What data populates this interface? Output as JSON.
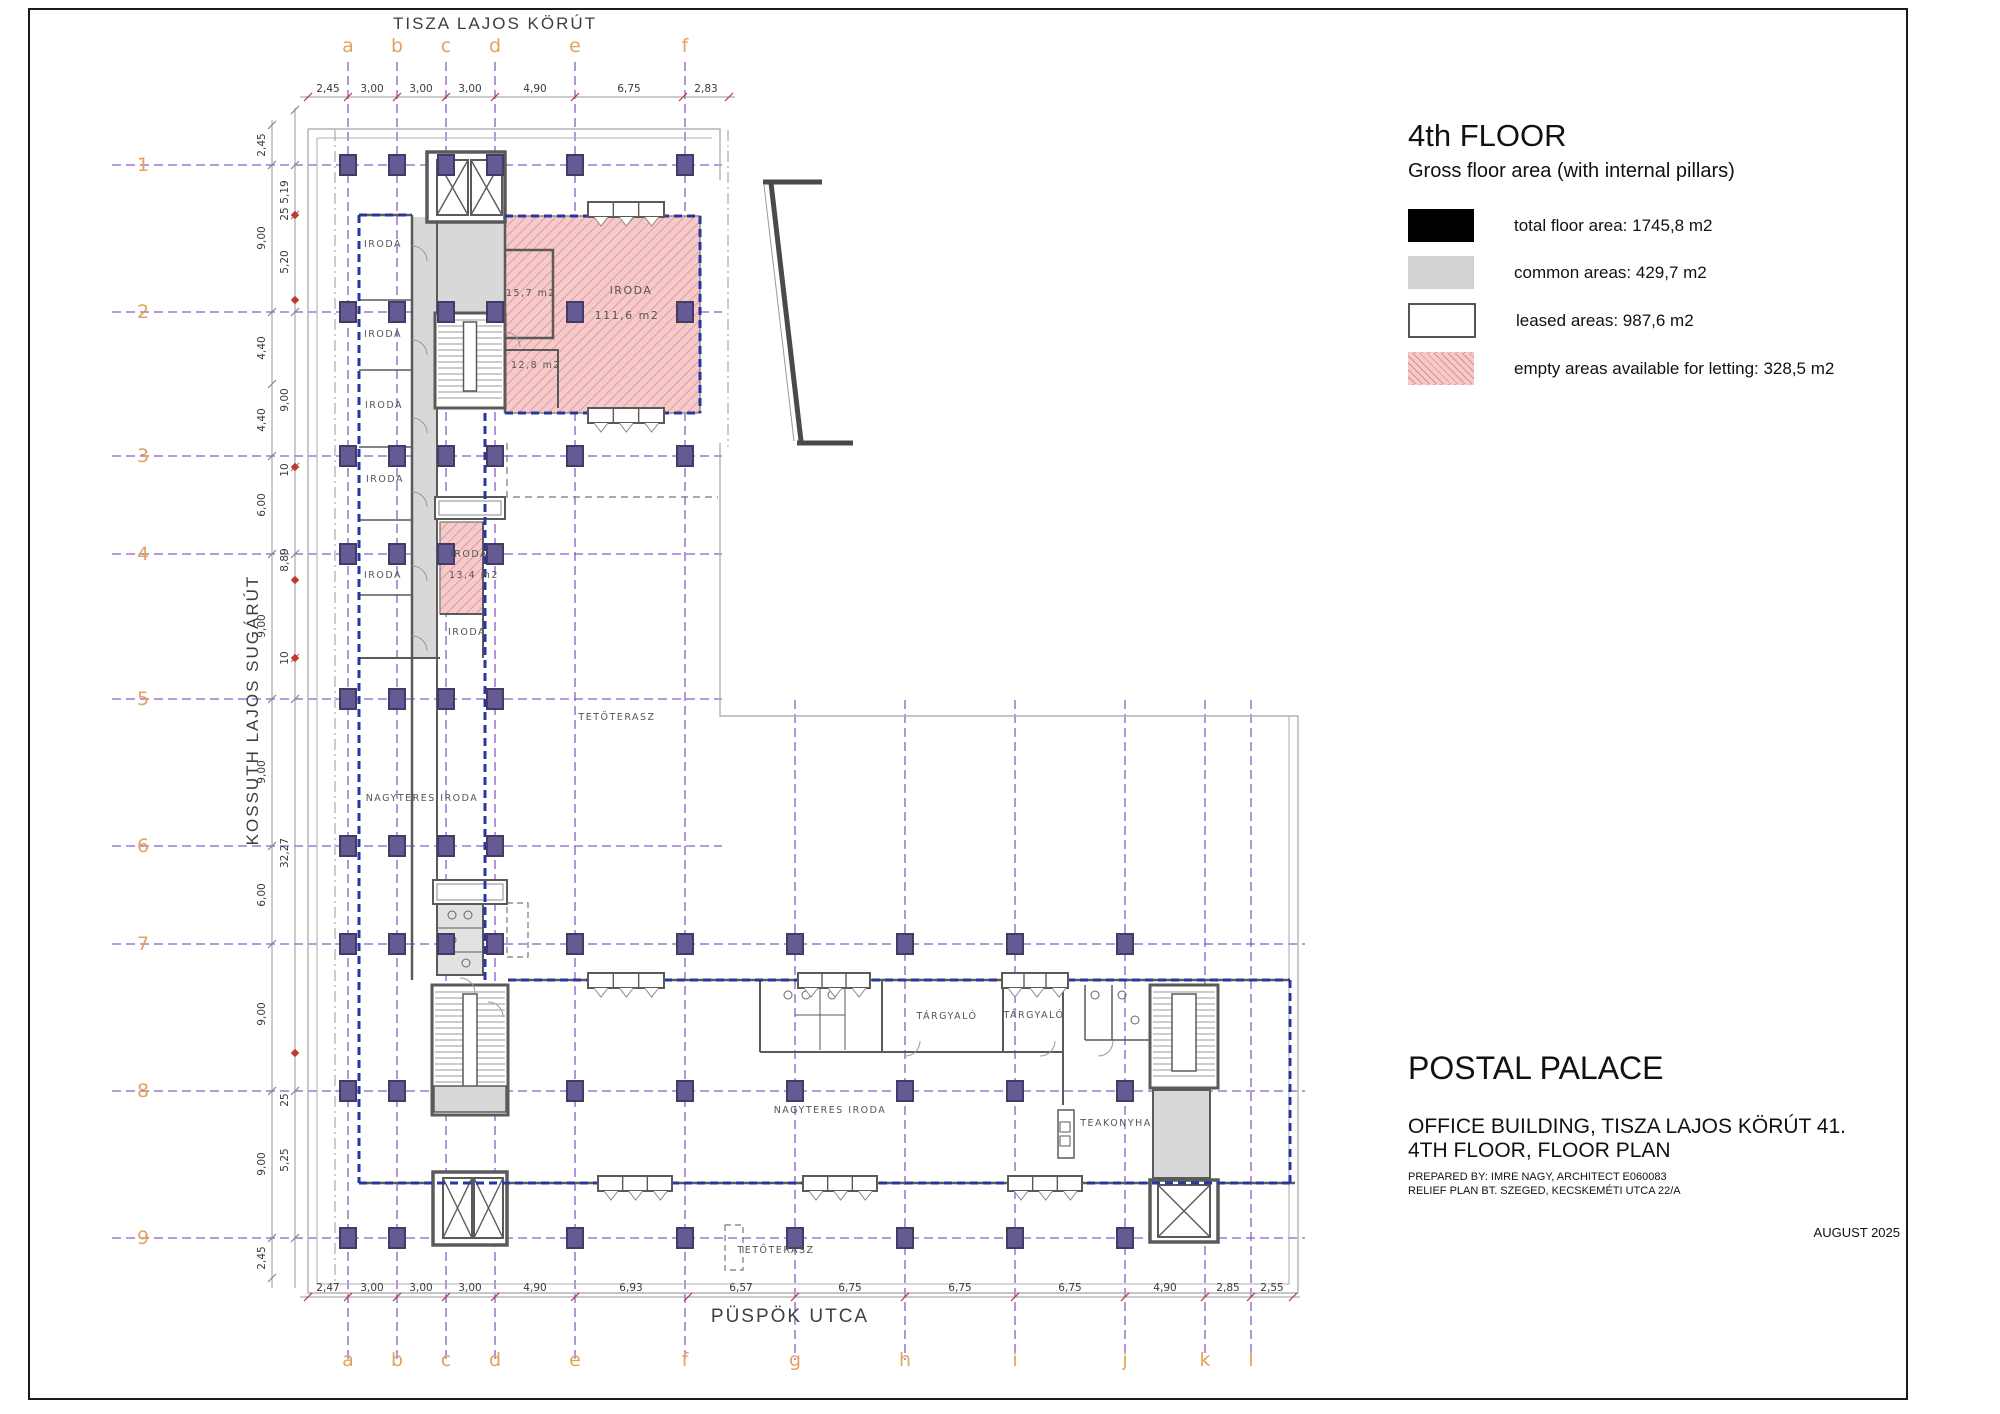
{
  "streets": {
    "top": "TISZA LAJOS KÖRÚT",
    "left": "KOSSUTH LAJOS SUGÁRÚT",
    "bottom": "PÜSPÖK UTCA"
  },
  "title_block": {
    "floor": "4th FLOOR",
    "subtitle": "Gross floor area (with internal pillars)",
    "legend": [
      {
        "swatch": "black",
        "label": "total floor area: 1745,8 m2"
      },
      {
        "swatch": "gray",
        "label": "common areas: 429,7 m2"
      },
      {
        "swatch": "white",
        "label": "leased areas: 987,6 m2"
      },
      {
        "swatch": "hatch",
        "label": "empty areas available for letting: 328,5 m2"
      }
    ]
  },
  "project_block": {
    "name": "POSTAL PALACE",
    "line1": "OFFICE BUILDING, TISZA LAJOS KÖRÚT 41.",
    "line2": "4TH FLOOR, FLOOR PLAN",
    "prepared1": "PREPARED BY: IMRE NAGY, ARCHITECT E060083",
    "prepared2": "RELIEF PLAN BT. SZEGED, KECSKEMÉTI UTCA 22/A",
    "date": "AUGUST 2025"
  },
  "grid": {
    "columns": [
      {
        "label": "a",
        "x": 348
      },
      {
        "label": "b",
        "x": 397
      },
      {
        "label": "c",
        "x": 446
      },
      {
        "label": "d",
        "x": 495
      },
      {
        "label": "e",
        "x": 575
      },
      {
        "label": "f",
        "x": 685
      },
      {
        "label": "g",
        "x": 795
      },
      {
        "label": "h",
        "x": 905
      },
      {
        "label": "i",
        "x": 1015
      },
      {
        "label": "j",
        "x": 1125
      },
      {
        "label": "k",
        "x": 1205
      },
      {
        "label": "l",
        "x": 1251
      }
    ],
    "top_letter_count": 6,
    "rows": [
      {
        "label": "1",
        "y": 165
      },
      {
        "label": "2",
        "y": 312
      },
      {
        "label": "3",
        "y": 456
      },
      {
        "label": "4",
        "y": 554
      },
      {
        "label": "5",
        "y": 699
      },
      {
        "label": "6",
        "y": 846
      },
      {
        "label": "7",
        "y": 944
      },
      {
        "label": "8",
        "y": 1091
      },
      {
        "label": "9",
        "y": 1238
      }
    ]
  },
  "dimensions": {
    "top": [
      {
        "t": "2,45",
        "x": 328
      },
      {
        "t": "3,00",
        "x": 372
      },
      {
        "t": "3,00",
        "x": 421
      },
      {
        "t": "3,00",
        "x": 470
      },
      {
        "t": "4,90",
        "x": 535
      },
      {
        "t": "6,75",
        "x": 629
      },
      {
        "t": "2,83",
        "x": 706
      }
    ],
    "bottom": [
      {
        "t": "2,47",
        "x": 328
      },
      {
        "t": "3,00",
        "x": 372
      },
      {
        "t": "3,00",
        "x": 421
      },
      {
        "t": "3,00",
        "x": 470
      },
      {
        "t": "4,90",
        "x": 535
      },
      {
        "t": "6,93",
        "x": 631
      },
      {
        "t": "6,57",
        "x": 741
      },
      {
        "t": "6,75",
        "x": 850
      },
      {
        "t": "6,75",
        "x": 960
      },
      {
        "t": "6,75",
        "x": 1070
      },
      {
        "t": "4,90",
        "x": 1165
      },
      {
        "t": "2,85",
        "x": 1228
      },
      {
        "t": "2,55",
        "x": 1272
      }
    ],
    "left_outer": [
      {
        "t": "2,45",
        "y": 145
      },
      {
        "t": "9,00",
        "y": 238
      },
      {
        "t": "4,40",
        "y": 348
      },
      {
        "t": "4,40",
        "y": 420
      },
      {
        "t": "6,00",
        "y": 505
      },
      {
        "t": "9,00",
        "y": 626
      },
      {
        "t": "9,00",
        "y": 772
      },
      {
        "t": "6,00",
        "y": 895
      },
      {
        "t": "9,00",
        "y": 1014
      },
      {
        "t": "9,00",
        "y": 1164
      },
      {
        "t": "2,45",
        "y": 1258
      }
    ],
    "left_inner": [
      {
        "t": "5,19",
        "y": 192
      },
      {
        "t": "25",
        "y": 214
      },
      {
        "t": "5,20",
        "y": 262
      },
      {
        "t": "9,00",
        "y": 400
      },
      {
        "t": "10",
        "y": 470
      },
      {
        "t": "8,89",
        "y": 560
      },
      {
        "t": "10",
        "y": 658
      },
      {
        "t": "32,27",
        "y": 853
      },
      {
        "t": "25",
        "y": 1100
      },
      {
        "t": "5,25",
        "y": 1160
      }
    ]
  },
  "plan": {
    "labels": [
      {
        "t": "IRODA",
        "x": 383,
        "y": 247
      },
      {
        "t": "IRODA",
        "x": 383,
        "y": 337
      },
      {
        "t": "IRODA",
        "x": 384,
        "y": 408
      },
      {
        "t": "IRODA",
        "x": 385,
        "y": 482
      },
      {
        "t": "IRODA",
        "x": 383,
        "y": 578
      },
      {
        "t": "IRODA",
        "x": 469,
        "y": 557
      },
      {
        "t": "13,4 m2",
        "x": 474,
        "y": 578
      },
      {
        "t": "IRODA",
        "x": 467,
        "y": 635
      },
      {
        "t": "15,7 m2",
        "x": 531,
        "y": 296
      },
      {
        "t": "IRODA",
        "x": 631,
        "y": 294,
        "fs": 11
      },
      {
        "t": "111,6 m2",
        "x": 627,
        "y": 319,
        "fs": 11
      },
      {
        "t": "12,8 m2",
        "x": 536,
        "y": 368
      },
      {
        "t": "NAGYTERES IRODA",
        "x": 422,
        "y": 801
      },
      {
        "t": "TETŐTERASZ",
        "x": 617,
        "y": 720
      },
      {
        "t": "NAGYTERES IRODA",
        "x": 830,
        "y": 1113
      },
      {
        "t": "TÁRGYALÓ",
        "x": 947,
        "y": 1019
      },
      {
        "t": "TÁRGYALÓ",
        "x": 1034,
        "y": 1018
      },
      {
        "t": "TEAKONYHA",
        "x": 1116,
        "y": 1126
      },
      {
        "t": "TETŐTERASZ",
        "x": 776,
        "y": 1253
      }
    ],
    "colors": {
      "grid_purple": "#8a5cc9",
      "pillar_fill": "#665a94",
      "pillar_stroke": "#443a66",
      "boundary_navy": "#2836a2",
      "empty_pink": "#f6caca",
      "hatch_stroke": "#d98f8f",
      "common_gray": "#d8d8d8",
      "wall_gray": "#5a5a5a",
      "accent_orange": "#e2a45c",
      "marker_red": "#c0392b",
      "dim_text": "#3a3a3a"
    }
  }
}
